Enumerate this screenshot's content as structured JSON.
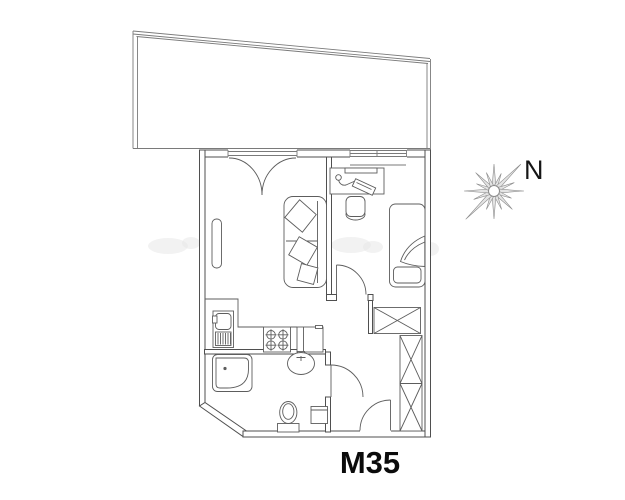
{
  "page": {
    "background": "#ffffff"
  },
  "plan": {
    "unit_label": "M35",
    "compass_label": "N",
    "colors": {
      "wall_line": "#4f4f4f",
      "thin_line": "#7a7a7a",
      "furniture_line": "#5d5d5d",
      "label_color": "#0b0b0b",
      "compass_fill": "#e4e4e4",
      "compass_stroke": "#8c8c8c",
      "watermark": "#e7e7e7",
      "background": "#ffffff"
    },
    "fixtures": [
      "terrace",
      "balcony-french-door",
      "bedroom-window",
      "sofa",
      "sofa-cushions",
      "radiator",
      "kitchen-counter",
      "kitchen-sink",
      "stove",
      "tall-cabinet",
      "shower-tray",
      "washbasin",
      "toilet",
      "washer-unit",
      "bedroom-door",
      "bathroom-door",
      "entrance-door",
      "closet",
      "wardrobe",
      "desk",
      "desk-lamp",
      "chair",
      "single-bed",
      "compass-star"
    ]
  }
}
